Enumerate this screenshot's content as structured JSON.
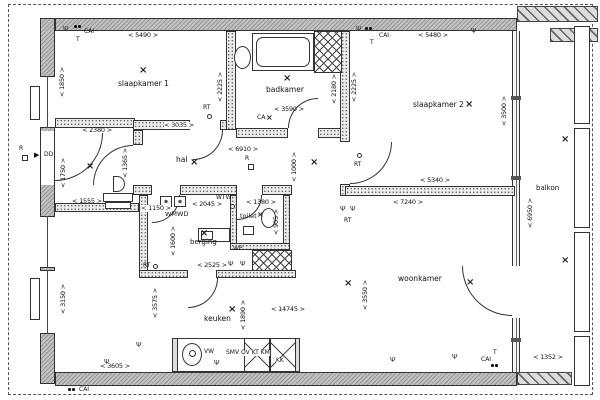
{
  "rooms": {
    "slaapkamer1": "slaapkamer 1",
    "badkamer": "badkamer",
    "slaapkamer2": "slaapkamer 2",
    "hal": "hal",
    "wmwd": "WMWD",
    "berging": "berging",
    "toilet": "toilet",
    "keuken": "keuken",
    "woonkamer": "woonkamer",
    "balkon": "balkon"
  },
  "dims": {
    "d5490": "< 5490 >",
    "d3590": "< 3590 >",
    "d5480": "< 5480 >",
    "d2380": "< 2380 >",
    "d3035": "< 3035 >",
    "d6910": "< 6910 >",
    "d5340": "< 5340 >",
    "d7240": "< 7240 >",
    "d1555": "< 1555 >",
    "d1150": "< 1150 >",
    "d2045": "< 2045 >",
    "d1380": "< 1380 >",
    "d2525": "< 2525 >",
    "d14745": "< 14745 >",
    "d3605": "< 3605 >",
    "d1352": "< 1352 >",
    "d1850": "< 1850 >",
    "d2225": "< 2225 >",
    "d2180": "< 2180 >",
    "d3500": "< 3500 >",
    "d1750": "< 1750 >",
    "d1365": "< 1365 >",
    "d1000": "< 1000 >",
    "d1600": "< 1600 >",
    "d905": "< 905 >",
    "d1890": "< 1890 >",
    "d3575": "< 3575 >",
    "d3150": "< 3150 >",
    "d3550": "< 3550 >",
    "d6950": "< 6950 >"
  },
  "labels": {
    "cai": "CAI",
    "t": "T",
    "rt": "RT",
    "r": "R",
    "dd": "DD",
    "ca": "CA",
    "wtw": "WTW",
    "wp": "WP",
    "vw": "VW",
    "smv": "SMV OV KT KM",
    "kk": "KK"
  },
  "icons": {
    "light": "×",
    "socket": "Ψ",
    "arrow": "▶"
  }
}
